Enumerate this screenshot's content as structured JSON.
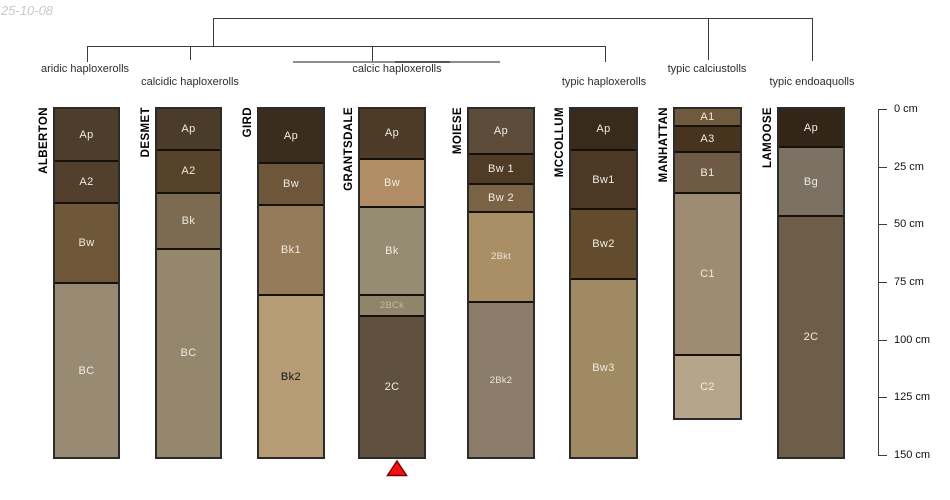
{
  "date_label": "25-10-08",
  "figure": {
    "width": 950,
    "height": 500,
    "background": "#ffffff"
  },
  "depth_axis": {
    "unit": "cm",
    "min": 0,
    "max": 150,
    "tick_interval": 25,
    "tick_labels": [
      "0 cm",
      "25 cm",
      "50 cm",
      "75 cm",
      "100 cm",
      "125 cm",
      "150 cm"
    ],
    "line_color": "#3c3c3c",
    "text_color": "#111111"
  },
  "tree": {
    "line_color": "#3c3c3c",
    "bracket_color": "#8e8e8e",
    "labels": [
      {
        "text": "aridic haploxerolls",
        "cx": 85,
        "top": 63
      },
      {
        "text": "calcidic haploxerolls",
        "cx": 190,
        "top": 76
      },
      {
        "text": "calcic haploxerolls",
        "cx": 397,
        "top": 63
      },
      {
        "text": "typic haploxerolls",
        "cx": 604,
        "top": 76
      },
      {
        "text": "typic calciustolls",
        "cx": 707,
        "top": 63
      },
      {
        "text": "typic endoaquolls",
        "cx": 812,
        "top": 76
      }
    ],
    "h_segments": [
      {
        "x1": 213,
        "x2": 812,
        "y": 18,
        "th": 1
      },
      {
        "x1": 87,
        "x2": 605,
        "y": 46,
        "th": 1
      },
      {
        "x1": 293,
        "x2": 500,
        "y": 61,
        "th": 2,
        "color": "#8e8e8e"
      },
      {
        "x1": 395,
        "x2": 450,
        "y": 61,
        "th": 2,
        "color": "#565656"
      }
    ],
    "v_segments": [
      {
        "x": 213,
        "y1": 18,
        "y2": 46
      },
      {
        "x": 708,
        "y1": 18,
        "y2": 60
      },
      {
        "x": 812,
        "y1": 18,
        "y2": 61
      },
      {
        "x": 87,
        "y1": 46,
        "y2": 62
      },
      {
        "x": 190,
        "y1": 46,
        "y2": 60
      },
      {
        "x": 372,
        "y1": 46,
        "y2": 61
      },
      {
        "x": 605,
        "y1": 46,
        "y2": 62
      }
    ]
  },
  "marker": {
    "shape": "triangle-up",
    "fill": "#f21111",
    "stroke": "#7f0000",
    "below_profile": "GRANTSDALE"
  },
  "chart_data": {
    "type": "bar",
    "subtype": "soil-profile-depth-columns",
    "title": "",
    "ylabel": "depth (cm)",
    "ylim": [
      0,
      150
    ],
    "categories": [
      "ALBERTON",
      "DESMET",
      "GIRD",
      "GRANTSDALE",
      "MOIESE",
      "MCCOLLUM",
      "MANHATTAN",
      "LAMOOSE"
    ],
    "groups": [
      {
        "label": "aridic haploxerolls",
        "members": [
          "ALBERTON"
        ]
      },
      {
        "label": "calcidic haploxerolls",
        "members": [
          "DESMET"
        ]
      },
      {
        "label": "calcic haploxerolls",
        "members": [
          "GIRD",
          "GRANTSDALE",
          "MOIESE"
        ]
      },
      {
        "label": "typic haploxerolls",
        "members": [
          "MCCOLLUM"
        ]
      },
      {
        "label": "typic calciustolls",
        "members": [
          "MANHATTAN"
        ]
      },
      {
        "label": "typic endoaquolls",
        "members": [
          "LAMOOSE"
        ]
      }
    ],
    "profiles": [
      {
        "name": "ALBERTON",
        "x": 53,
        "width": 67,
        "horizons": [
          {
            "label": "Ap",
            "top_cm": 0,
            "bottom_cm": 23,
            "color": "#4e3d2b",
            "label_color": "#efece4"
          },
          {
            "label": "A2",
            "top_cm": 23,
            "bottom_cm": 41,
            "color": "#52402c",
            "label_color": "#efece4"
          },
          {
            "label": "Bw",
            "top_cm": 41,
            "bottom_cm": 76,
            "color": "#6f5839",
            "label_color": "#efece4"
          },
          {
            "label": "BC",
            "top_cm": 76,
            "bottom_cm": 151,
            "color": "#998b73",
            "label_color": "#efece4"
          }
        ]
      },
      {
        "name": "DESMET",
        "x": 155,
        "width": 67,
        "horizons": [
          {
            "label": "Ap",
            "top_cm": 0,
            "bottom_cm": 18,
            "color": "#4b3b29",
            "label_color": "#efece4"
          },
          {
            "label": "A2",
            "top_cm": 18,
            "bottom_cm": 37,
            "color": "#57422a",
            "label_color": "#efece4"
          },
          {
            "label": "Bk",
            "top_cm": 37,
            "bottom_cm": 61,
            "color": "#7c6b50",
            "label_color": "#efece4"
          },
          {
            "label": "BC",
            "top_cm": 61,
            "bottom_cm": 151,
            "color": "#94876d",
            "label_color": "#efece4"
          }
        ]
      },
      {
        "name": "GIRD",
        "x": 257,
        "width": 68,
        "horizons": [
          {
            "label": "Ap",
            "top_cm": 0,
            "bottom_cm": 24,
            "color": "#3b2d1e",
            "label_color": "#efece4"
          },
          {
            "label": "Bw",
            "top_cm": 24,
            "bottom_cm": 42,
            "color": "#6d563a",
            "label_color": "#efece4"
          },
          {
            "label": "Bk1",
            "top_cm": 42,
            "bottom_cm": 81,
            "color": "#957b59",
            "label_color": "#efece4"
          },
          {
            "label": "Bk2",
            "top_cm": 81,
            "bottom_cm": 151,
            "color": "#b59c75",
            "label_color": "#141414"
          }
        ]
      },
      {
        "name": "GRANTSDALE",
        "x": 358,
        "width": 68,
        "horizons": [
          {
            "label": "Ap",
            "top_cm": 0,
            "bottom_cm": 22,
            "color": "#4d3b27",
            "label_color": "#efece4"
          },
          {
            "label": "Bw",
            "top_cm": 22,
            "bottom_cm": 43,
            "color": "#b08d64",
            "label_color": "#efece4"
          },
          {
            "label": "Bk",
            "top_cm": 43,
            "bottom_cm": 81,
            "color": "#968b73",
            "label_color": "#efece4"
          },
          {
            "label": "2BCk",
            "top_cm": 81,
            "bottom_cm": 90,
            "color": "#908469",
            "label_color": "#c3b89f",
            "small": true
          },
          {
            "label": "2C",
            "top_cm": 90,
            "bottom_cm": 151,
            "color": "#60513e",
            "label_color": "#efece4"
          }
        ]
      },
      {
        "name": "MOIESE",
        "x": 467,
        "width": 68,
        "horizons": [
          {
            "label": "Ap",
            "top_cm": 0,
            "bottom_cm": 20,
            "color": "#5d4c39",
            "label_color": "#efece4"
          },
          {
            "label": "Bw 1",
            "top_cm": 20,
            "bottom_cm": 33,
            "color": "#4f3b26",
            "label_color": "#efece4"
          },
          {
            "label": "Bw 2",
            "top_cm": 33,
            "bottom_cm": 45,
            "color": "#7a6345",
            "label_color": "#efece4"
          },
          {
            "label": "2Bkt",
            "top_cm": 45,
            "bottom_cm": 84,
            "color": "#a98e66",
            "label_color": "#e9e4d8",
            "small": true
          },
          {
            "label": "2Bk2",
            "top_cm": 84,
            "bottom_cm": 151,
            "color": "#8c7c6a",
            "label_color": "#e9e4d8",
            "small": true
          }
        ]
      },
      {
        "name": "MCCOLLUM",
        "x": 569,
        "width": 69,
        "horizons": [
          {
            "label": "Ap",
            "top_cm": 0,
            "bottom_cm": 18,
            "color": "#392b1c",
            "label_color": "#efece4"
          },
          {
            "label": "Bw1",
            "top_cm": 18,
            "bottom_cm": 44,
            "color": "#4c3825",
            "label_color": "#efece4"
          },
          {
            "label": "Bw2",
            "top_cm": 44,
            "bottom_cm": 74,
            "color": "#634c2e",
            "label_color": "#efece4"
          },
          {
            "label": "Bw3",
            "top_cm": 74,
            "bottom_cm": 151,
            "color": "#a08a63",
            "label_color": "#efece4"
          }
        ]
      },
      {
        "name": "MANHATTAN",
        "x": 673,
        "width": 69,
        "horizons": [
          {
            "label": "A1",
            "top_cm": 0,
            "bottom_cm": 8,
            "color": "#6f5a3d",
            "label_color": "#efece4"
          },
          {
            "label": "A3",
            "top_cm": 8,
            "bottom_cm": 19,
            "color": "#46341f",
            "label_color": "#efece4"
          },
          {
            "label": "B1",
            "top_cm": 19,
            "bottom_cm": 37,
            "color": "#6f5b45",
            "label_color": "#efece4"
          },
          {
            "label": "C1",
            "top_cm": 37,
            "bottom_cm": 107,
            "color": "#9d8c72",
            "label_color": "#efece4"
          },
          {
            "label": "C2",
            "top_cm": 107,
            "bottom_cm": 134,
            "color": "#b5a68a",
            "label_color": "#efece4"
          }
        ]
      },
      {
        "name": "LAMOOSE",
        "x": 777,
        "width": 68,
        "horizons": [
          {
            "label": "Ap",
            "top_cm": 0,
            "bottom_cm": 17,
            "color": "#332619",
            "label_color": "#efece4"
          },
          {
            "label": "Bg",
            "top_cm": 17,
            "bottom_cm": 47,
            "color": "#7b7263",
            "label_color": "#efece4"
          },
          {
            "label": "2C",
            "top_cm": 47,
            "bottom_cm": 151,
            "color": "#6e5d48",
            "label_color": "#efece4"
          }
        ]
      }
    ]
  }
}
